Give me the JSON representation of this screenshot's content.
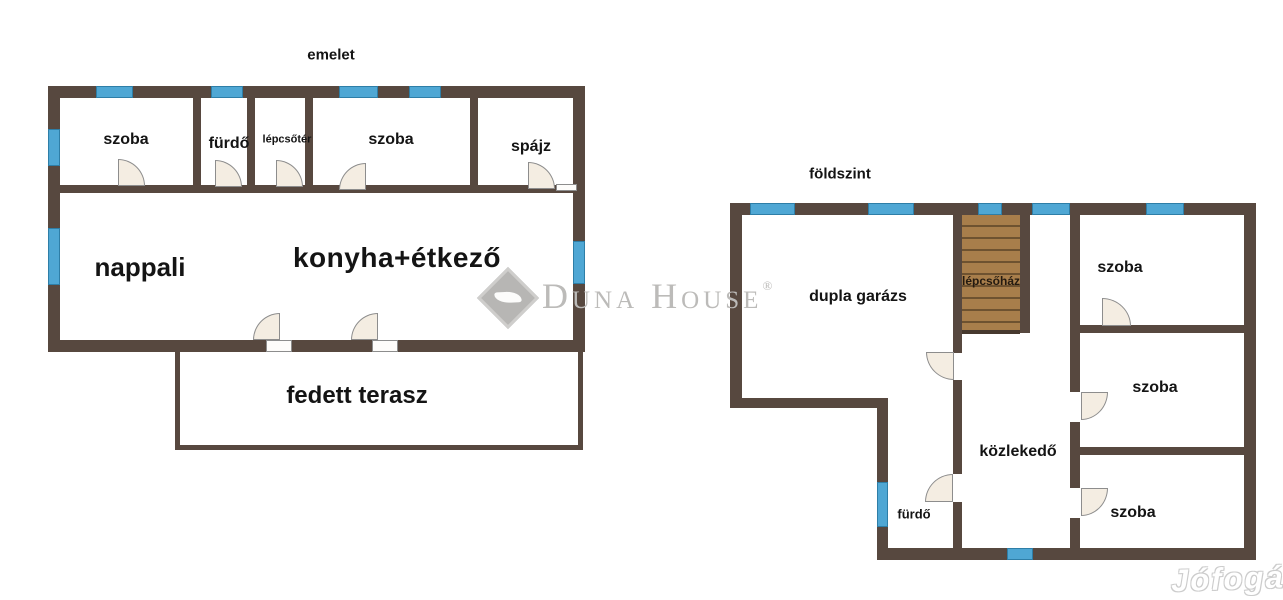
{
  "colors": {
    "background": "#ffffff",
    "wall": "#57483f",
    "window_fill": "#4fa7d4",
    "window_border": "#2e7ea7",
    "stairs_fill": "#a87e4b",
    "stairs_line": "#6e5230",
    "door_fill": "#f4ede2",
    "door_border": "#8d8d8d",
    "label": "#141414",
    "stair_label": "#241a10",
    "watermark": "#bcbbb9",
    "jofogas_outline": "#cccccc"
  },
  "floors": {
    "emelet": {
      "title": "emelet",
      "rooms": {
        "szoba_top_left": "szoba",
        "furdo": "fürdő",
        "lepcsoter": "lépcsőtér",
        "szoba_top_right": "szoba",
        "spajz": "spájz",
        "nappali": "nappali",
        "konyha_etkezo": "konyha+étkező",
        "fedett_terasz": "fedett terasz"
      }
    },
    "foldszint": {
      "title": "földszint",
      "rooms": {
        "dupla_garazs": "dupla garázs",
        "lepcsohaz": "lépcsőház",
        "szoba_top": "szoba",
        "szoba_middle": "szoba",
        "szoba_bottom": "szoba",
        "kozlekedo": "közlekedő",
        "furdo": "fürdő"
      }
    }
  },
  "watermarks": {
    "duna_house_text": "Duna House",
    "registered_mark": "®",
    "jofogas_text": "Jófogás"
  }
}
